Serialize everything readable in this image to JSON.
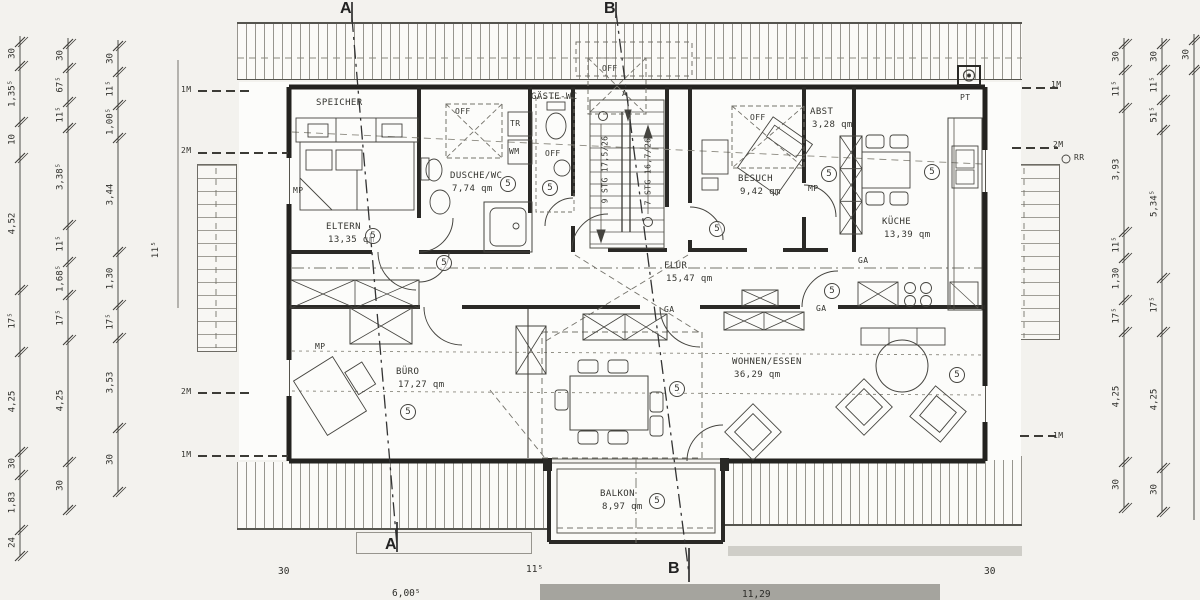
{
  "unit_badge": "5",
  "rooms": [
    {
      "id": "speicher",
      "name": "SPEICHER",
      "area": ""
    },
    {
      "id": "eltern",
      "name": "ELTERN",
      "area": "13,35 qm"
    },
    {
      "id": "dusche",
      "name": "DUSCHE/WC",
      "area": "7,74 qm"
    },
    {
      "id": "gaeste_wc",
      "name": "GÄSTE-WC",
      "area": ""
    },
    {
      "id": "besuch",
      "name": "BESUCH",
      "area": "9,42 qm"
    },
    {
      "id": "abst",
      "name": "ABST",
      "area": "3,28 qm"
    },
    {
      "id": "kueche",
      "name": "KÜCHE",
      "area": "13,39 qm"
    },
    {
      "id": "flur",
      "name": "FLUR",
      "area": "15,47 qm"
    },
    {
      "id": "buero",
      "name": "BÜRO",
      "area": "17,27 qm"
    },
    {
      "id": "wohnen_essen",
      "name": "WOHNEN/ESSEN",
      "area": "36,29 qm"
    },
    {
      "id": "balkon",
      "name": "BALKON",
      "area": "8,97 qm"
    }
  ],
  "stairs": {
    "flight_up": "9 STG 17,5/26",
    "flight_down": "7 STG 16,7/26"
  },
  "section_markers": {
    "a": "A",
    "b": "B"
  },
  "labels": {
    "off": "OFF",
    "tr": "TR",
    "wm": "WM",
    "mp": "MP",
    "ga": "GA",
    "pt": "PT",
    "rr": "RR",
    "one_meter": "1M",
    "two_meter": "2M",
    "wall_dim": "11⁵"
  },
  "dimensions": {
    "left_chains": [
      [
        "30",
        "1,35⁵",
        "10",
        "4,52",
        "17⁵",
        "4,25",
        "30",
        "1,83",
        "24"
      ],
      [
        "30",
        "67⁵",
        "11⁵",
        "3,38⁵",
        "11⁵",
        "1,68⁵",
        "17⁵",
        "4,25",
        "30"
      ],
      [
        "30",
        "11⁵",
        "1,00⁵",
        "3,44",
        "1,30",
        "17⁵",
        "3,53",
        "30"
      ]
    ],
    "right_chains": [
      [
        "30",
        "11⁵",
        "3,93",
        "11⁵",
        "1,30",
        "17⁵",
        "4,25",
        "30"
      ],
      [
        "30",
        "11⁵",
        "51⁵",
        "5,34⁵",
        "17⁵",
        "4,25",
        "30"
      ],
      [
        "30"
      ]
    ],
    "bottom": [
      "30",
      "6,00⁵",
      "11⁵",
      "11,29",
      "30"
    ]
  }
}
